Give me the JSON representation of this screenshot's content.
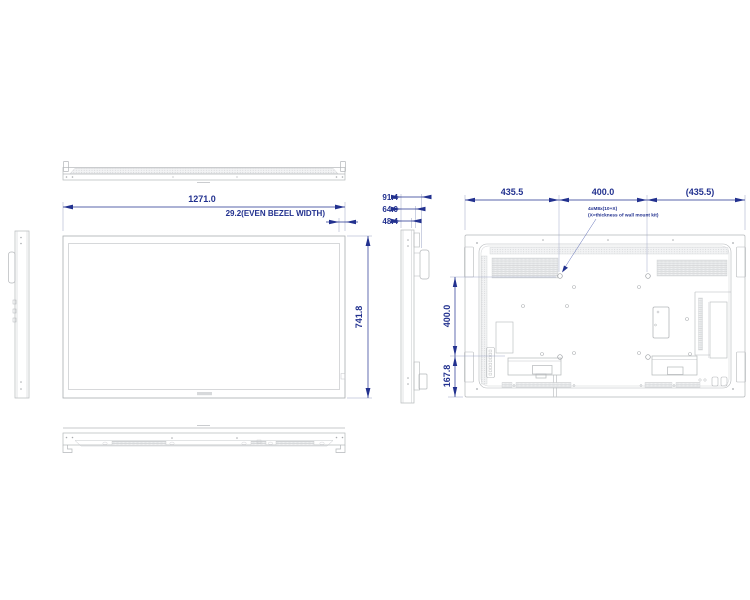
{
  "drawing": {
    "front_view": {
      "width_dim": "1271.0",
      "bezel_dim": "29.2(EVEN BEZEL WIDTH)",
      "height_dim": "741.8"
    },
    "side_view": {
      "depth_total": "91.4",
      "depth_mid": "64.0",
      "depth_body": "48.4"
    },
    "rear_view": {
      "mount_left": "435.5",
      "mount_center": "400.0",
      "mount_right": "(435.5)",
      "mount_vertical": "400.0",
      "mount_bottom": "167.8",
      "note_line1": "4xM8x(10+X)",
      "note_line2": "(X=thickness of wall mount kit)"
    },
    "colors": {
      "dimension_blue": "#22318f",
      "drawing_gray": "#b4b7ba"
    }
  }
}
